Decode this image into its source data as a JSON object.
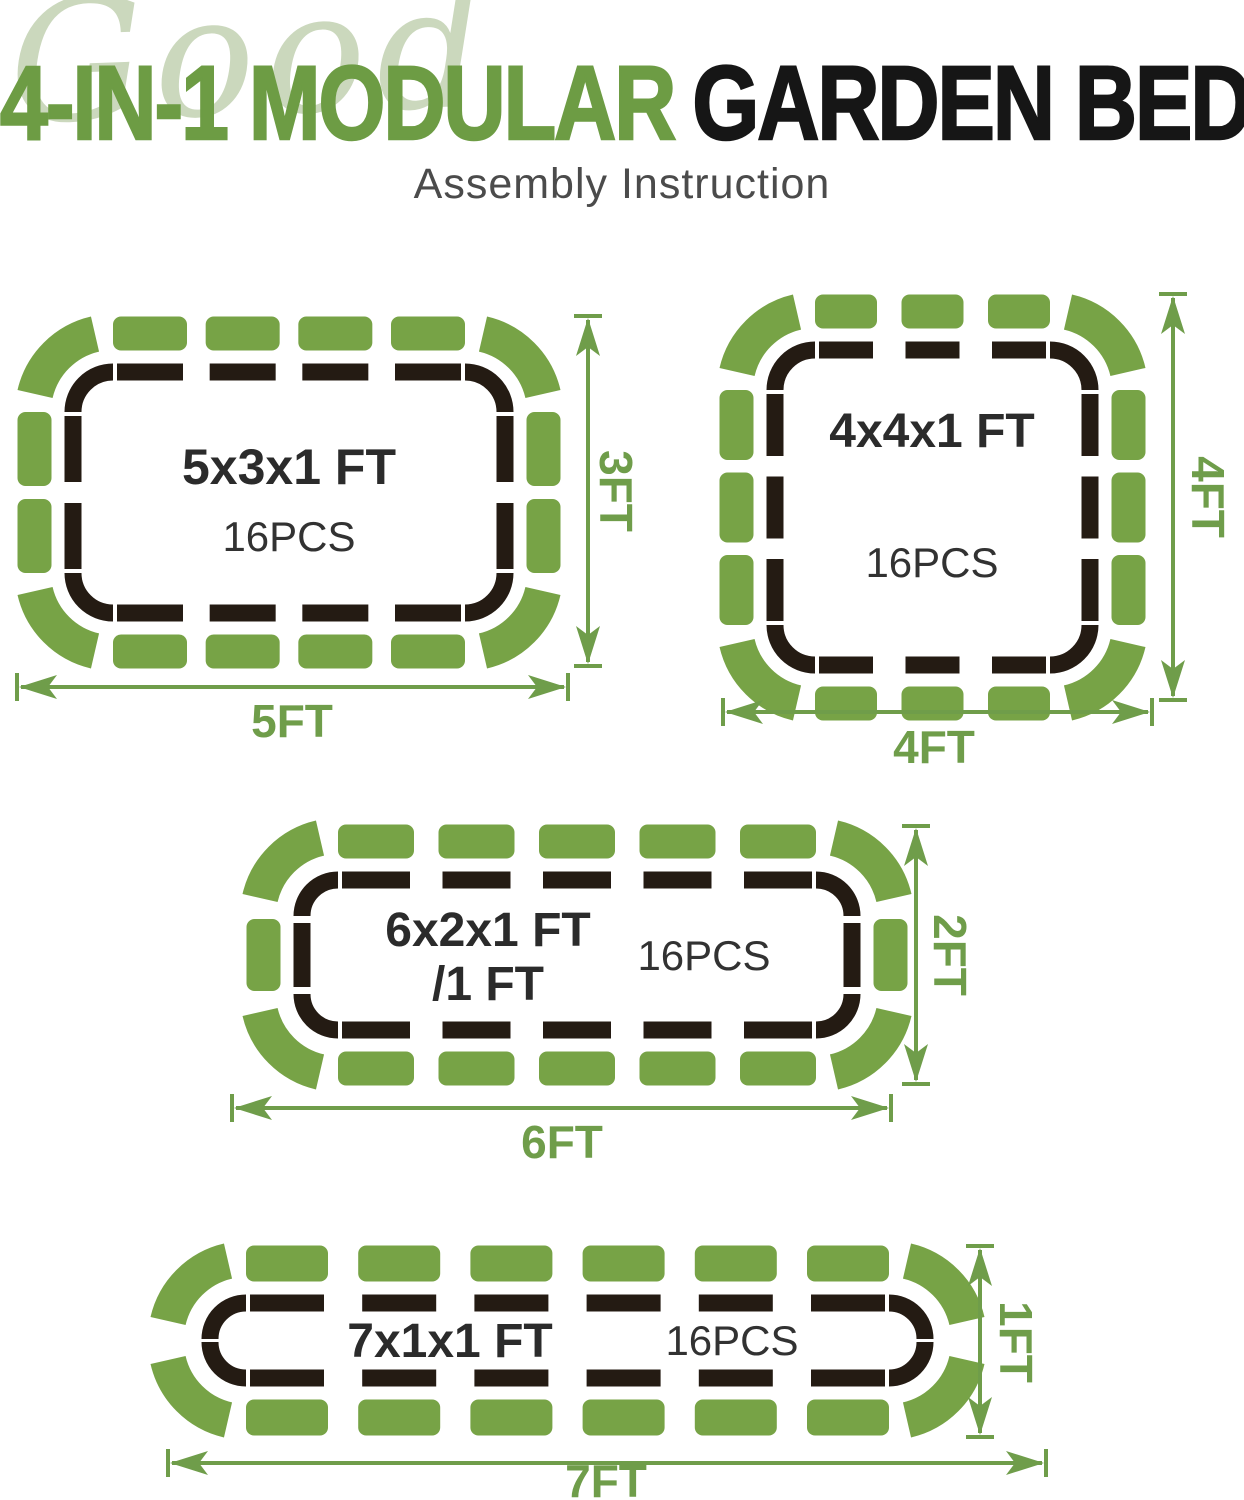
{
  "header": {
    "watermark": "Good",
    "title_green": "4-IN-1 MODULAR",
    "title_black": "GARDEN BED",
    "subtitle": "Assembly Instruction"
  },
  "colors": {
    "piece_green": "#77a346",
    "dim_green": "#6f9d4a",
    "outline_dark": "#241b13",
    "title_green": "#6d9c44",
    "title_black": "#161616",
    "subtitle_gray": "#4b4b4b",
    "watermark_green": "#cbd8bd",
    "label_dark": "#2b2b2b",
    "pcs_dark": "#323232",
    "background": "#ffffff"
  },
  "diagrams": [
    {
      "id": "bed-5x3",
      "size_label": "5x3x1 FT",
      "size_label_line2": "",
      "pieces_count_label": "16PCS",
      "width_label": "5FT",
      "height_label": "3FT",
      "piece_layout": {
        "top": 4,
        "bottom": 4,
        "left": 2,
        "right": 2,
        "corners": 4,
        "total": 16
      }
    },
    {
      "id": "bed-4x4",
      "size_label": "4x4x1 FT",
      "size_label_line2": "",
      "pieces_count_label": "16PCS",
      "width_label": "4FT",
      "height_label": "4FT",
      "piece_layout": {
        "top": 3,
        "bottom": 3,
        "left": 3,
        "right": 3,
        "corners": 4,
        "total": 16
      }
    },
    {
      "id": "bed-6x2",
      "size_label": "6x2x1 FT",
      "size_label_line2": "/1 FT",
      "pieces_count_label": "16PCS",
      "width_label": "6FT",
      "height_label": "2FT",
      "piece_layout": {
        "top": 5,
        "bottom": 5,
        "left": 1,
        "right": 1,
        "corners": 4,
        "total": 16
      }
    },
    {
      "id": "bed-7x1",
      "size_label": "7x1x1 FT",
      "size_label_line2": "",
      "pieces_count_label": "16PCS",
      "width_label": "7FT",
      "height_label": "1FT",
      "piece_layout": {
        "top": 6,
        "bottom": 6,
        "left": 0,
        "right": 0,
        "corners": 4,
        "total": 16
      }
    }
  ]
}
